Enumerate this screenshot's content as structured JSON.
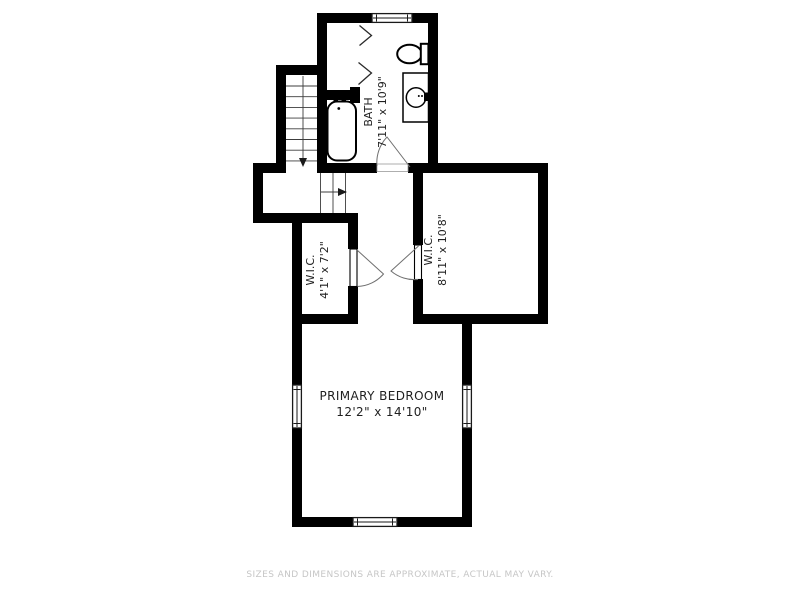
{
  "page": {
    "type": "floor-plan",
    "background": "#ffffff"
  },
  "rooms": {
    "bath": {
      "name": "BATH",
      "dims": "7'11\" x 10'9\""
    },
    "wic_left": {
      "name": "W.I.C.",
      "dims": "4'1\" x 7'2\""
    },
    "wic_right": {
      "name": "W.I.C.",
      "dims": "8'11\" x 10'8\""
    },
    "bedroom": {
      "name": "PRIMARY BEDROOM",
      "dims": "12'2\" x 14'10\""
    }
  },
  "fixtures": [
    "staircase-with-down-arrows",
    "bathtub",
    "shower-door-chevrons",
    "toilet",
    "vanity-sink",
    "window-symbols",
    "door-swing-arcs"
  ],
  "footer": {
    "disclaimer": "SIZES AND DIMENSIONS ARE APPROXIMATE, ACTUAL MAY VARY."
  },
  "colors": {
    "walls": "#000000",
    "labels": "#1f1f1f",
    "thin_lines": "#3c3c3c",
    "door_arcs": "#6f6f6f",
    "disclaimer_text": "#c6c6c6"
  }
}
